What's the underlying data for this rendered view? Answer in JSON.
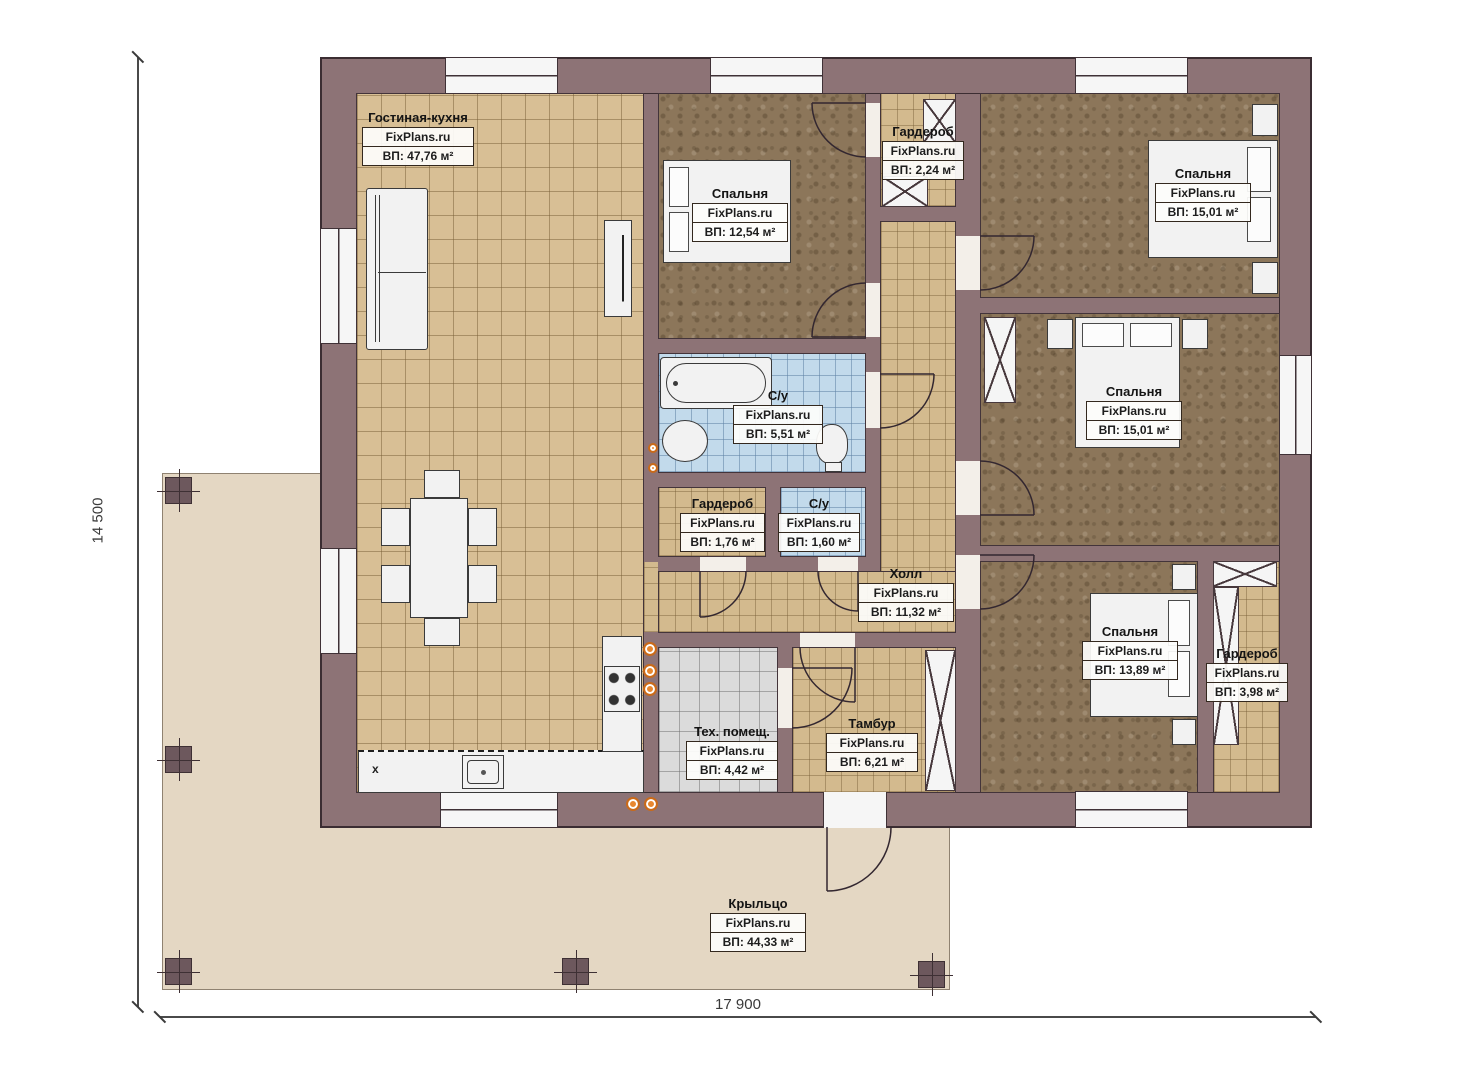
{
  "plan": {
    "dimensions": {
      "height": "14 500",
      "width": "17 900"
    },
    "kitchen_mark": "x",
    "rooms": [
      {
        "name": "Гостиная-кухня",
        "brand": "FixPlans.ru",
        "area": "ВП: 47,76 м²"
      },
      {
        "name": "Спальня",
        "brand": "FixPlans.ru",
        "area": "ВП: 12,54 м²"
      },
      {
        "name": "Гардероб",
        "brand": "FixPlans.ru",
        "area": "ВП: 2,24 м²"
      },
      {
        "name": "Спальня",
        "brand": "FixPlans.ru",
        "area": "ВП: 15,01 м²"
      },
      {
        "name": "Спальня",
        "brand": "FixPlans.ru",
        "area": "ВП: 15,01 м²"
      },
      {
        "name": "С/у",
        "brand": "FixPlans.ru",
        "area": "ВП: 5,51 м²"
      },
      {
        "name": "Гардероб",
        "brand": "FixPlans.ru",
        "area": "ВП: 1,76 м²"
      },
      {
        "name": "С/у",
        "brand": "FixPlans.ru",
        "area": "ВП: 1,60 м²"
      },
      {
        "name": "Холл",
        "brand": "FixPlans.ru",
        "area": "ВП: 11,32 м²"
      },
      {
        "name": "Спальня",
        "brand": "FixPlans.ru",
        "area": "ВП: 13,89 м²"
      },
      {
        "name": "Гардероб",
        "brand": "FixPlans.ru",
        "area": "ВП: 3,98 м²"
      },
      {
        "name": "Тех. помещ.",
        "brand": "FixPlans.ru",
        "area": "ВП: 4,42 м²"
      },
      {
        "name": "Тамбур",
        "brand": "FixPlans.ru",
        "area": "ВП: 6,21 м²"
      },
      {
        "name": "Крыльцо",
        "brand": "FixPlans.ru",
        "area": "ВП: 44,33 м²"
      }
    ]
  }
}
